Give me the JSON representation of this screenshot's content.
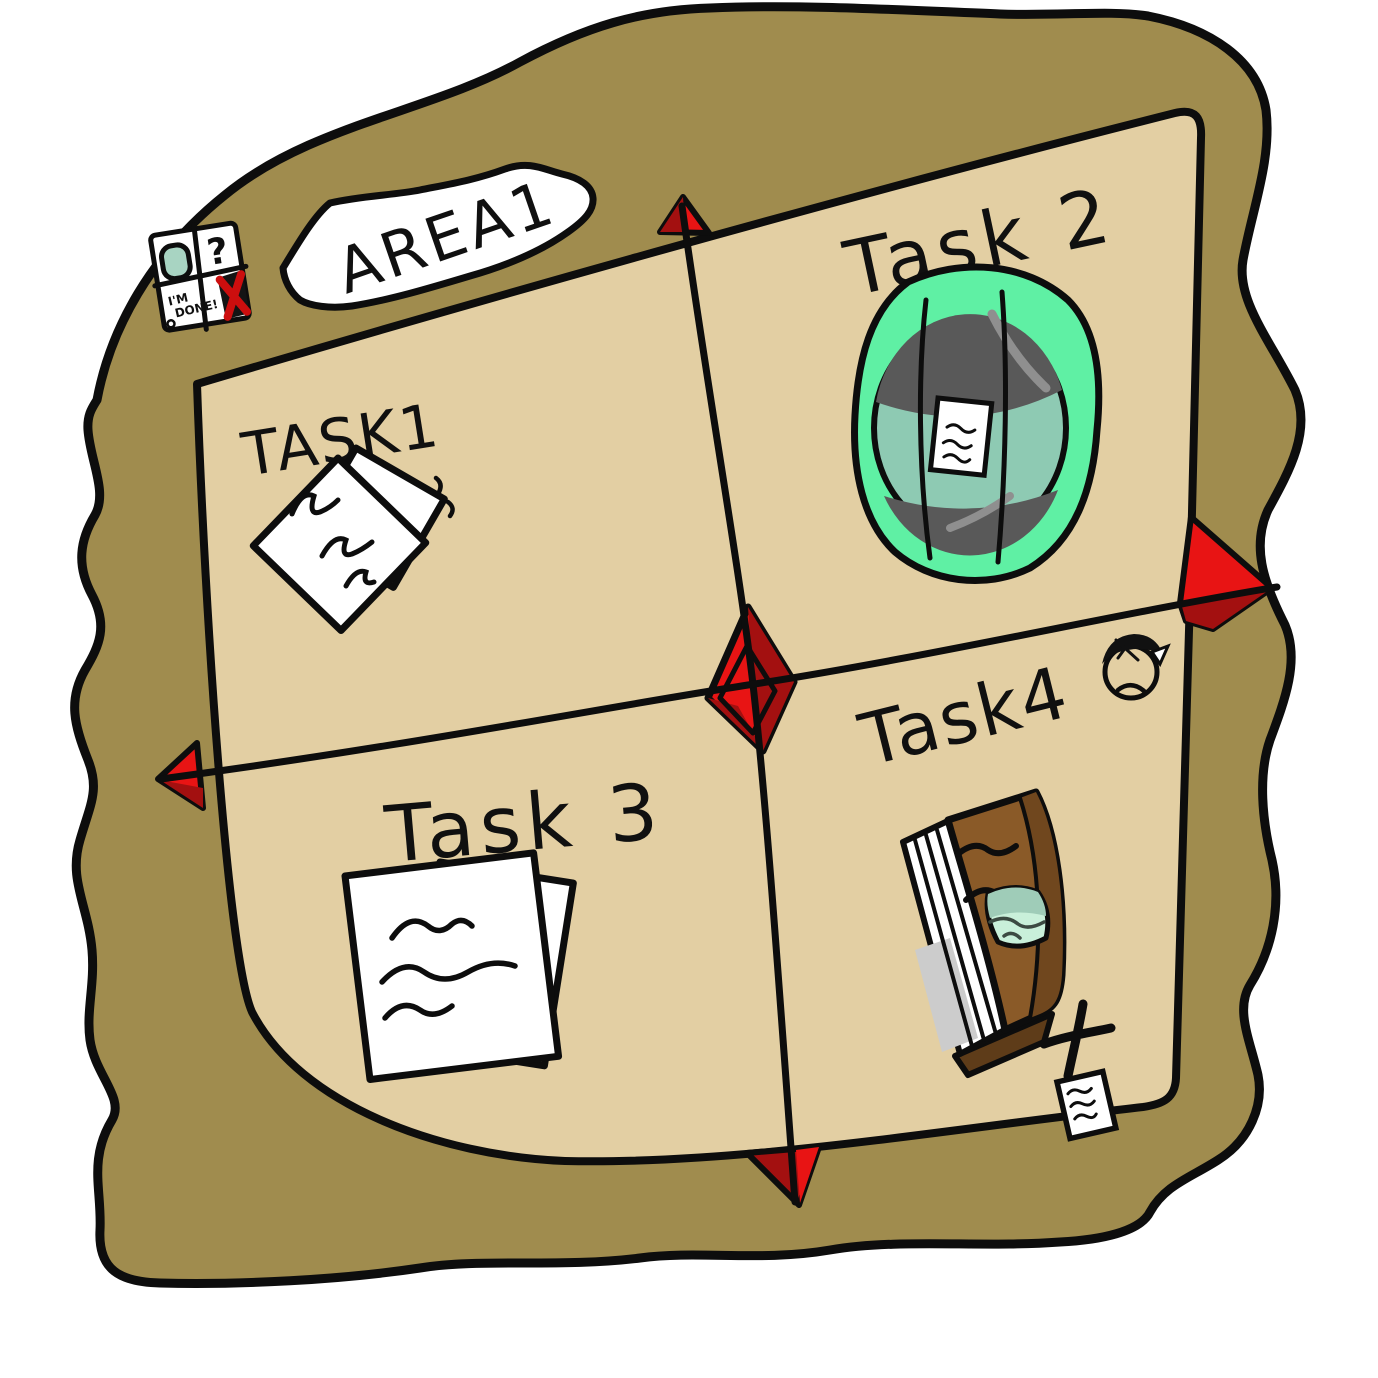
{
  "map": {
    "area_banner": "AREA1",
    "legend": {
      "question_mark": "?",
      "scribble_line1": "I'M",
      "scribble_line2": "DONE!",
      "icons": {
        "portal": "portal-icon",
        "x": "x-mark-icon"
      }
    },
    "tasks": [
      {
        "id": "task1",
        "label": "TASK1",
        "marker": "papers"
      },
      {
        "id": "task2",
        "label": "Task 2",
        "marker": "portal"
      },
      {
        "id": "task3",
        "label": "Task 3",
        "marker": "papers"
      },
      {
        "id": "task4",
        "label": "Task4",
        "marker": "book"
      }
    ],
    "compass": {
      "center_marker": "red-diamond",
      "edge_markers": [
        "top",
        "right",
        "bottom",
        "left"
      ]
    },
    "colors": {
      "background": "#ffffff",
      "parchment_outer": "#a08c4e",
      "map_inner": "#e3cfa3",
      "marker_red": "#e81414",
      "marker_red_dark": "#a31010",
      "portal_green": "#5ff0a4",
      "portal_teal": "#8ecab3",
      "portal_gray": "#595959",
      "book_brown": "#8a5a28",
      "ink": "#0d0d0d"
    }
  }
}
